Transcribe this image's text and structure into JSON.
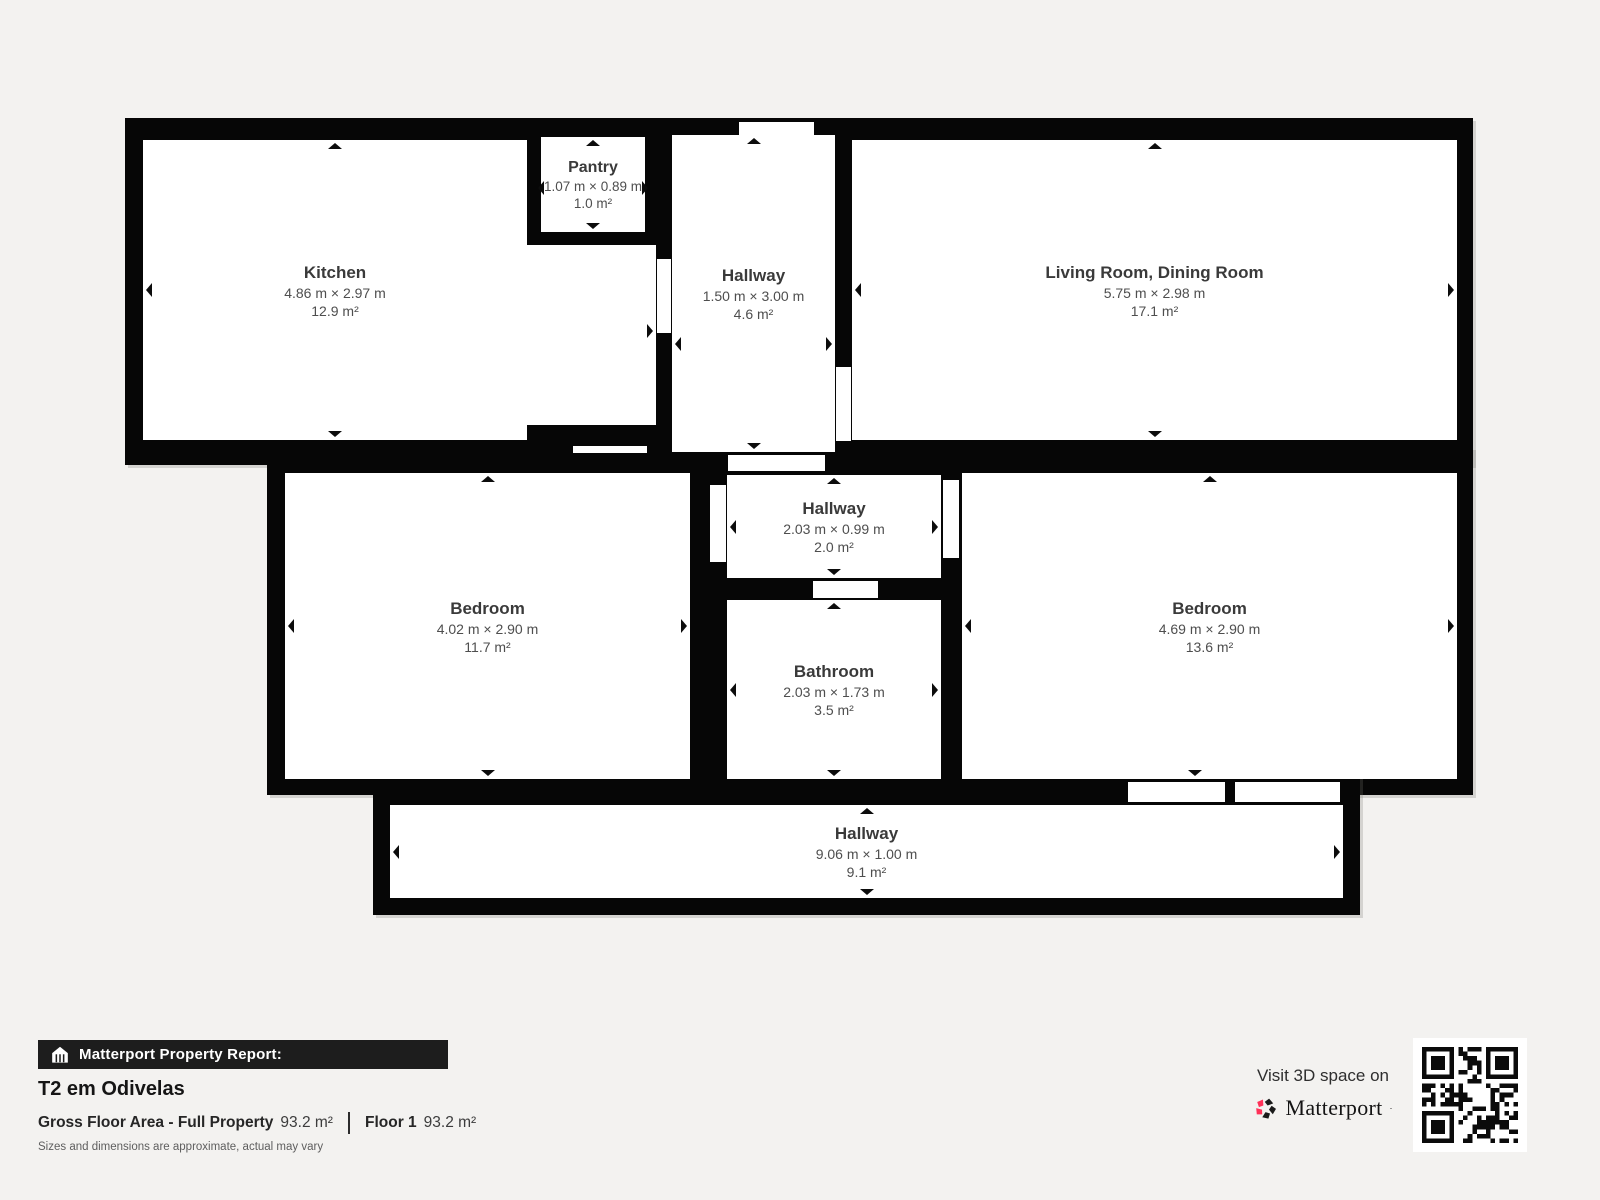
{
  "plan": {
    "rooms": {
      "kitchen": {
        "name": "Kitchen",
        "dims": "4.86 m × 2.97 m",
        "area": "12.9 m²"
      },
      "pantry": {
        "name": "Pantry",
        "dims": "1.07 m × 0.89 m",
        "area": "1.0 m²"
      },
      "hallway_top": {
        "name": "Hallway",
        "dims": "1.50 m × 3.00 m",
        "area": "4.6 m²"
      },
      "living": {
        "name": "Living Room, Dining Room",
        "dims": "5.75 m × 2.98 m",
        "area": "17.1 m²"
      },
      "bedroom_left": {
        "name": "Bedroom",
        "dims": "4.02 m × 2.90 m",
        "area": "11.7 m²"
      },
      "hallway_middle": {
        "name": "Hallway",
        "dims": "2.03 m × 0.99 m",
        "area": "2.0 m²"
      },
      "bathroom": {
        "name": "Bathroom",
        "dims": "2.03 m × 1.73 m",
        "area": "3.5 m²"
      },
      "bedroom_right": {
        "name": "Bedroom",
        "dims": "4.69 m × 2.90 m",
        "area": "13.6 m²"
      },
      "hallway_bottom": {
        "name": "Hallway",
        "dims": "9.06 m × 1.00 m",
        "area": "9.1 m²"
      }
    }
  },
  "footer": {
    "report_label": "Matterport Property Report:",
    "property_title": "T2 em Odivelas",
    "gross_area_label": "Gross Floor Area - Full Property",
    "gross_area_value": "93.2 m²",
    "floor_label": "Floor 1",
    "floor_value": "93.2 m²",
    "disclaimer": "Sizes and dimensions are approximate, actual may vary",
    "visit_text": "Visit 3D space on",
    "brand": "Matterport",
    "brand_mark": "·"
  },
  "colors": {
    "background": "#f3f2f0",
    "wall": "#060606",
    "room_fill": "#ffffff",
    "banner": "#1d1d1d",
    "accent_pink": "#ff3158",
    "room_text": "#3a3a3a"
  }
}
